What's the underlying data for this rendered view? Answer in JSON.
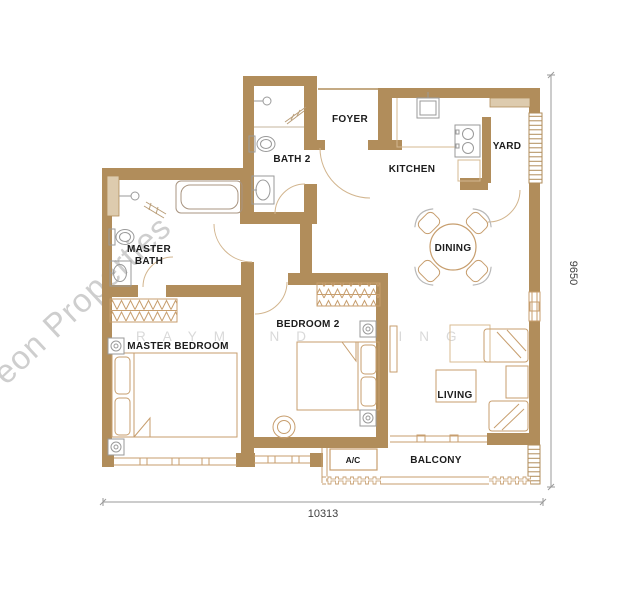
{
  "plan": {
    "title": "2-bedroom unit floor plan",
    "rooms": {
      "foyer": "FOYER",
      "kitchen": "KITCHEN",
      "yard": "YARD",
      "bath2": "BATH 2",
      "master_bath_line1": "MASTER",
      "master_bath_line2": "BATH",
      "dining": "DINING",
      "bedroom2": "BEDROOM 2",
      "master_bedroom": "MASTER BEDROOM",
      "living": "LIVING",
      "ac": "A/C",
      "balcony": "BALCONY"
    },
    "dimensions": {
      "width_mm": "10313",
      "height_mm": "9650"
    },
    "watermarks": {
      "diagonal": "eon Properties",
      "name_left": "RAYMOND",
      "name_right": "LING"
    },
    "colors": {
      "wall": "#b18d5b",
      "wall_light": "#ddcbae",
      "furniture": "#c79e6e",
      "fixture": "#9a9a9a",
      "door_arc": "#d2b58e",
      "dimension_line": "#9a9a9a",
      "label": "#1c1c1c",
      "watermark": "#c6c6c6"
    }
  }
}
